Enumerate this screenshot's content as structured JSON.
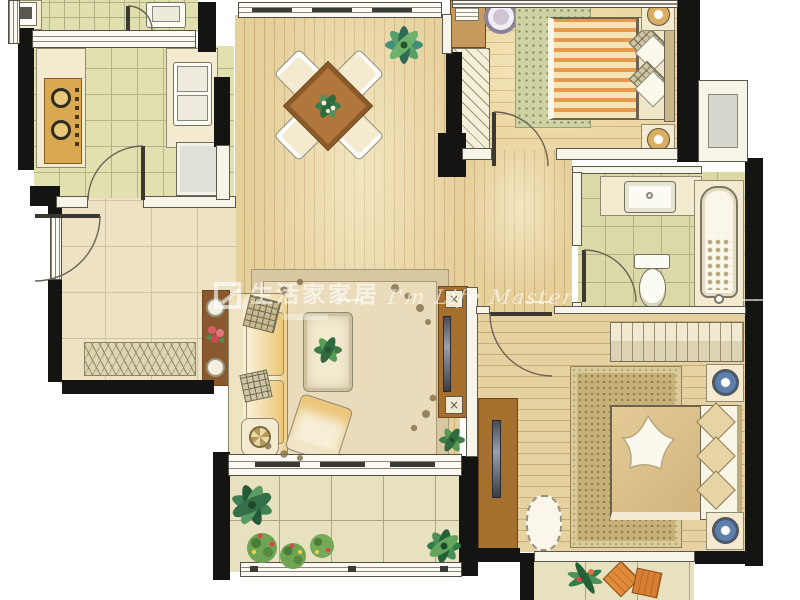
{
  "watermark": {
    "brand": "生活家家居",
    "separator": "——",
    "slogan": "I'm Life Master",
    "color": "#ffffff"
  },
  "rooms": [
    {
      "id": "utility-balcony",
      "furniture": [
        "washer",
        "counter",
        "laundry-basin",
        "door-arc"
      ]
    },
    {
      "id": "kitchen",
      "furniture": [
        "gas-stove-2-burner",
        "counter",
        "double-sink",
        "refrigerator",
        "door-arc"
      ]
    },
    {
      "id": "dining-room",
      "furniture": [
        "square-dining-table-rot45",
        "dining-chair-x4",
        "table-centerpiece-plant",
        "potted-plant"
      ]
    },
    {
      "id": "entry-foyer",
      "furniture": [
        "entry-door-arc",
        "doormat",
        "console-table",
        "flower-vase",
        "plates"
      ]
    },
    {
      "id": "living-room",
      "furniture": [
        "sofa",
        "throw-pillows",
        "area-rug",
        "coffee-table",
        "coffee-table-plant",
        "armchair",
        "side-table",
        "tv-console",
        "tv",
        "speaker-x2",
        "corner-plant"
      ]
    },
    {
      "id": "bedroom-2",
      "furniture": [
        "desk",
        "books",
        "round-chair",
        "wardrobe",
        "rug",
        "double-bed-orange-stripes",
        "pillows",
        "nightstand-with-lamp-x2",
        "door-arc",
        "window"
      ]
    },
    {
      "id": "hallway",
      "furniture": []
    },
    {
      "id": "bathroom",
      "furniture": [
        "vanity-counter",
        "washbasin",
        "toilet",
        "bathtub",
        "door-arc"
      ]
    },
    {
      "id": "bay-window-niche",
      "furniture": [
        "window-ledge"
      ]
    },
    {
      "id": "master-bedroom",
      "furniture": [
        "wardrobe",
        "rug",
        "double-bed",
        "star-throw",
        "pillows-x3",
        "nightstand-with-blue-lamp-x2",
        "tv-cabinet",
        "tv",
        "ottoman",
        "door-arc"
      ]
    },
    {
      "id": "main-balcony",
      "furniture": [
        "monstera-plant",
        "flower-bushes",
        "shrub",
        "potted-plant",
        "railing",
        "sliding-window"
      ]
    },
    {
      "id": "rear-balcony",
      "furniture": [
        "plant",
        "orange-cushion-x2"
      ]
    }
  ],
  "palette": {
    "wall": "#141412",
    "wood_floor": "#e5cf9b",
    "bedroom_floor": "#ecd8a4",
    "kitchen_tile": "#e3e0b0",
    "bath_tile": "#dbd9a7",
    "marble": "#ede3c4",
    "balcony_tile": "#e8e1bf",
    "furniture_wood": "#b0763c",
    "counter_cream": "#f3ead0",
    "duvet_orange_stripe": "#e59a4f",
    "master_duvet": "#dcc28f",
    "lamp_blue": "#5f7fa8",
    "plant_green": "#3e7d49",
    "cushion_orange": "#e08a3a"
  }
}
